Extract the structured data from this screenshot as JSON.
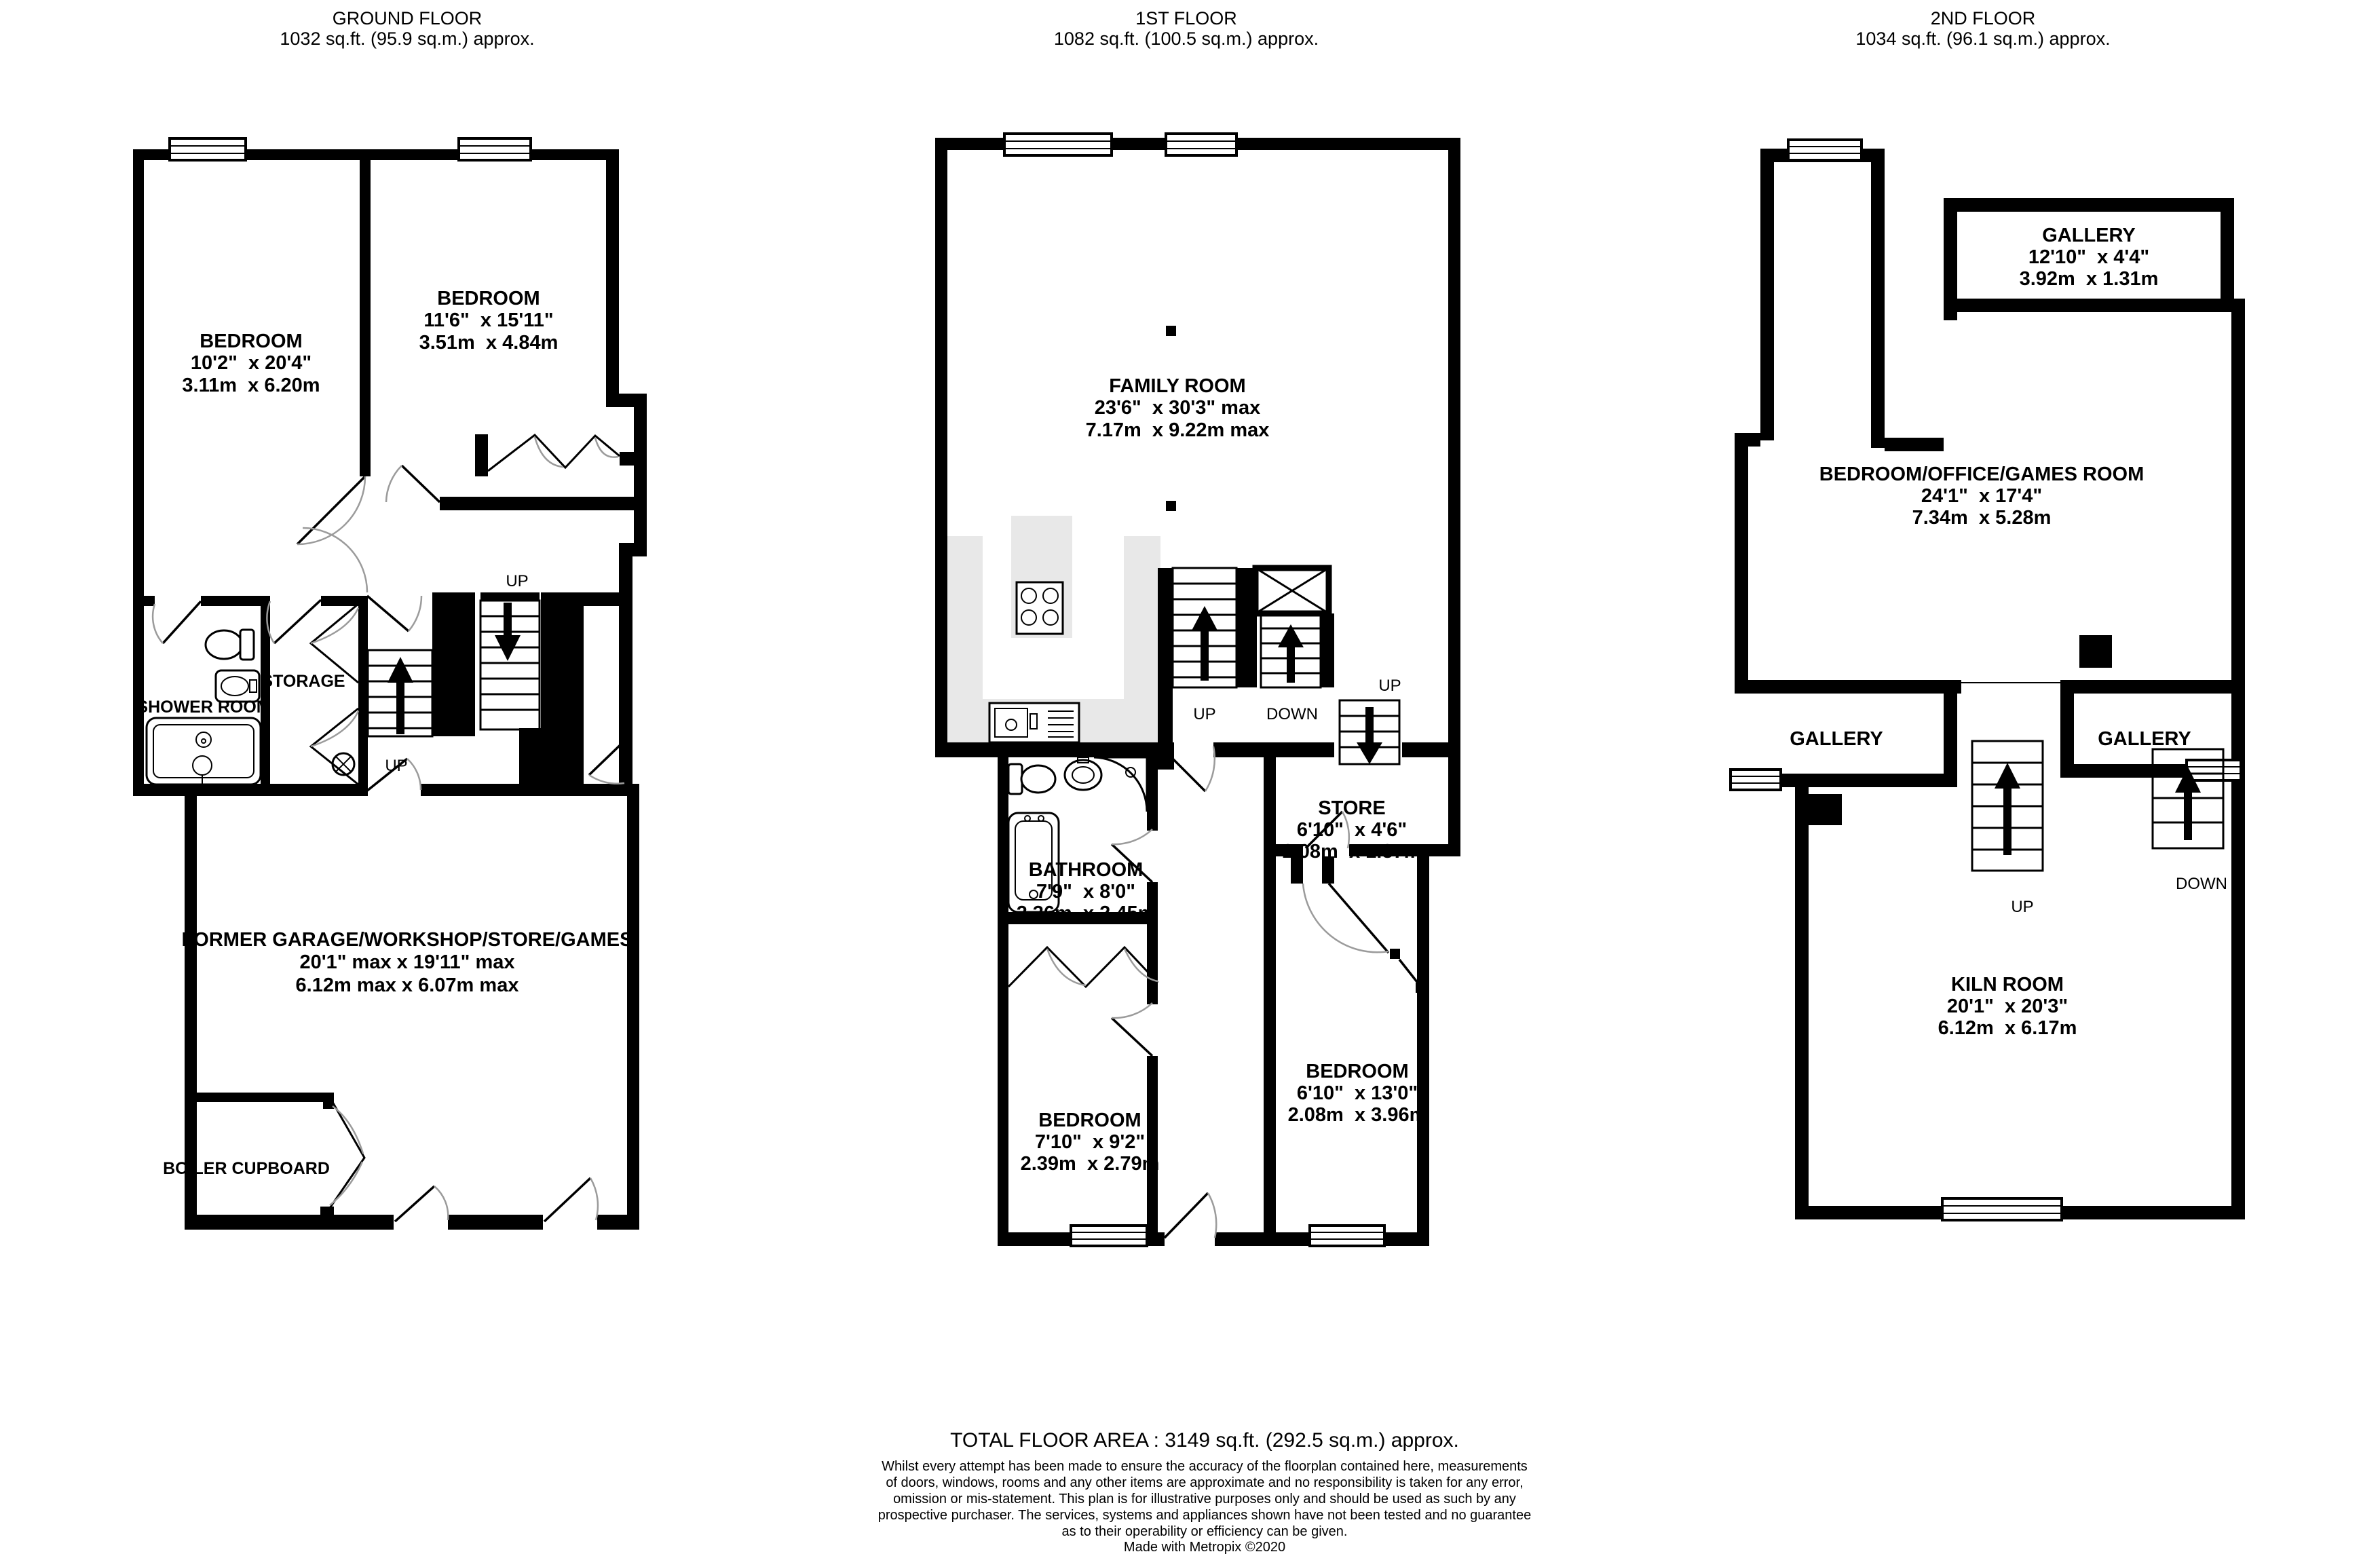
{
  "page": {
    "background": "#ffffff",
    "wall_color": "#000000",
    "kitchen_counter_color": "#e8e8e8"
  },
  "floors": {
    "ground": {
      "title": "GROUND FLOOR",
      "area": "1032 sq.ft. (95.9 sq.m.) approx.",
      "bedroom1": {
        "name": "BEDROOM",
        "imperial": "10'2\"  x 20'4\"",
        "metric": "3.11m  x 6.20m"
      },
      "bedroom2": {
        "name": "BEDROOM",
        "imperial": "11'6\"  x 15'11\"",
        "metric": "3.51m  x 4.84m"
      },
      "shower_room": {
        "name": "SHOWER ROOM"
      },
      "storage": {
        "name": "STORAGE"
      },
      "garage": {
        "name": "FORMER GARAGE/WORKSHOP/STORE/GAMES",
        "imperial": "20'1\" max x 19'11\" max",
        "metric": "6.12m max x 6.07m max"
      },
      "boiler_cupboard": {
        "name": "BOILER CUPBOARD"
      },
      "stair_label_hall": "UP",
      "stair_label_lower": "UP"
    },
    "first": {
      "title": "1ST FLOOR",
      "area": "1082 sq.ft. (100.5 sq.m.) approx.",
      "family_room": {
        "name": "FAMILY ROOM",
        "imperial": "23'6\"  x 30'3\" max",
        "metric": "7.17m  x 9.22m max"
      },
      "bathroom": {
        "name": "BATHROOM",
        "imperial": "7'9\"  x 8'0\"",
        "metric": "2.36m  x 2.45m"
      },
      "store": {
        "name": "STORE",
        "imperial": "6'10\"  x 4'6\"",
        "metric": "2.08m  x 1.37m"
      },
      "bedroom_left": {
        "name": "BEDROOM",
        "imperial": "7'10\"  x 9'2\"",
        "metric": "2.39m  x 2.79m"
      },
      "bedroom_right": {
        "name": "BEDROOM",
        "imperial": "6'10\"  x 13'0\"",
        "metric": "2.08m  x 3.96m"
      },
      "stair_label_up": "UP",
      "stair_label_down": "DOWN",
      "stair_label_up_right": "UP"
    },
    "second": {
      "title": "2ND FLOOR",
      "area": "1034 sq.ft. (96.1 sq.m.) approx.",
      "gallery_top": {
        "name": "GALLERY",
        "imperial": "12'10\"  x 4'4\"",
        "metric": "3.92m  x 1.31m"
      },
      "bedroom_office": {
        "name": "BEDROOM/OFFICE/GAMES ROOM",
        "imperial": "24'1\"  x 17'4\"",
        "metric": "7.34m  x 5.28m"
      },
      "gallery_left": {
        "name": "GALLERY"
      },
      "gallery_right": {
        "name": "GALLERY"
      },
      "kiln_room": {
        "name": "KILN ROOM",
        "imperial": "20'1\"  x 20'3\"",
        "metric": "6.12m  x 6.17m"
      },
      "stair_label_up": "UP",
      "stair_label_down": "DOWN"
    }
  },
  "footer": {
    "total": "TOTAL FLOOR AREA : 3149 sq.ft. (292.5 sq.m.) approx.",
    "disclaimer": [
      "Whilst every attempt has been made to ensure the accuracy of the floorplan contained here, measurements",
      "of doors, windows, rooms and any other items are approximate and no responsibility is taken for any error,",
      "omission or mis-statement. This plan is for illustrative purposes only and should be used as such by any",
      "prospective purchaser. The services, systems and appliances shown have not been tested and no guarantee",
      "as to their operability or efficiency can be given."
    ],
    "credit": "Made with Metropix ©2020"
  }
}
